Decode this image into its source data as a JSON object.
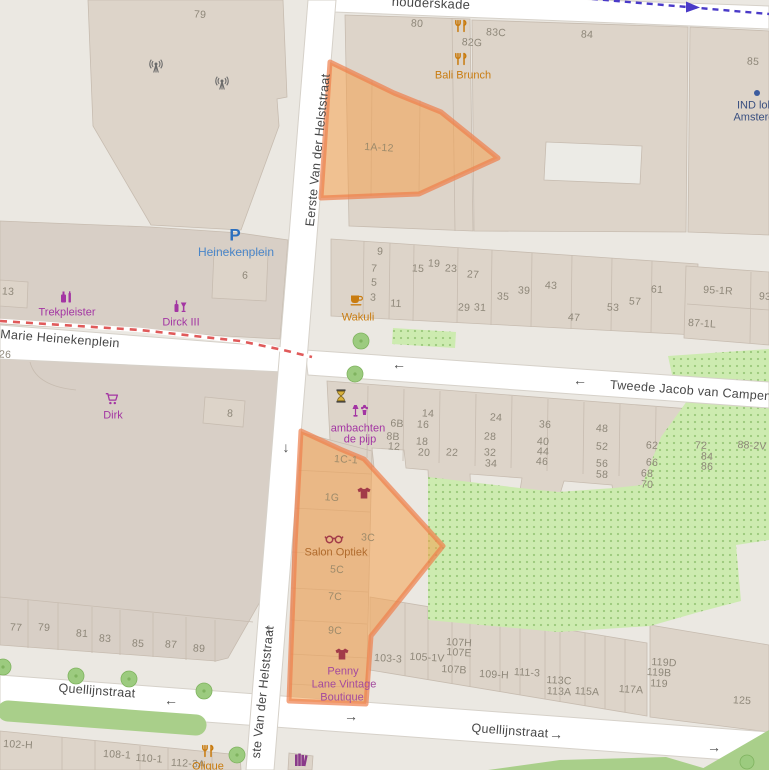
{
  "map": {
    "description_note": "OpenStreetMap-style map extract with two orange highlighted plots"
  },
  "colors": {
    "background": "#ebe8e2",
    "road": "#ffffff",
    "road_casing": "#d6d1c9",
    "building": "#ddd4c9",
    "building_dark": "#d8cfc6",
    "building_stroke": "#c7bcb0",
    "green_area": "#cdebb0",
    "green_dots": "#9cc97c",
    "grass": "#a9cf8a",
    "tree": "#9ccb7f",
    "tree_stroke": "#7fb35f",
    "selection_fill": "#f4a14f",
    "selection_stroke": "#ee7f4b",
    "route_blue": "#4a3ac8",
    "tram_dash_red": "#e05a5a",
    "house_number": "#8e8779",
    "selection_label": "#9c8a6a",
    "street_label": "#474747",
    "shop_purple": "#a335a3",
    "food_orange": "#c97c10",
    "clothes_maroon": "#a23b49",
    "parking_blue": "#2c6fbe",
    "label_blue": "#4a86c8",
    "ind_blue": "#3a5080"
  },
  "street_labels": [
    {
      "t": "houderskade",
      "x": 431,
      "y": 3,
      "r": 2.5,
      "s": 13
    },
    {
      "t": "Eerste Van der Helststraat",
      "x": 318,
      "y": 150,
      "r": -84,
      "s": 12.5
    },
    {
      "t": "ste Van der Helststraat",
      "x": 263,
      "y": 692,
      "r": -84,
      "s": 12.5
    },
    {
      "t": "Marie Heinekenplein",
      "x": 60,
      "y": 339,
      "r": 4.5,
      "s": 12.5
    },
    {
      "t": "Tweede Jacob van Campens",
      "x": 694,
      "y": 391,
      "r": 4.2,
      "s": 12.5
    },
    {
      "t": "Quellijnstraat",
      "x": 97,
      "y": 691,
      "r": 4.2,
      "s": 12.5
    },
    {
      "t": "Quellijnstraat",
      "x": 510,
      "y": 731,
      "r": 4.2,
      "s": 12.5
    }
  ],
  "house_numbers": [
    {
      "t": "79",
      "x": 200,
      "y": 15
    },
    {
      "t": "80",
      "x": 417,
      "y": 24
    },
    {
      "t": "82G",
      "x": 472,
      "y": 43
    },
    {
      "t": "83C",
      "x": 496,
      "y": 33
    },
    {
      "t": "84",
      "x": 587,
      "y": 35
    },
    {
      "t": "85",
      "x": 753,
      "y": 62
    },
    {
      "t": "13",
      "x": 8,
      "y": 292
    },
    {
      "t": "6",
      "x": 245,
      "y": 276
    },
    {
      "t": "26",
      "x": 5,
      "y": 355
    },
    {
      "t": "9",
      "x": 380,
      "y": 252
    },
    {
      "t": "7",
      "x": 374,
      "y": 269
    },
    {
      "t": "5",
      "x": 374,
      "y": 283
    },
    {
      "t": "3",
      "x": 373,
      "y": 298
    },
    {
      "t": "11",
      "x": 396,
      "y": 304
    },
    {
      "t": "15",
      "x": 418,
      "y": 269
    },
    {
      "t": "19",
      "x": 434,
      "y": 264
    },
    {
      "t": "23",
      "x": 451,
      "y": 269
    },
    {
      "t": "27",
      "x": 473,
      "y": 275
    },
    {
      "t": "29",
      "x": 464,
      "y": 308
    },
    {
      "t": "31",
      "x": 480,
      "y": 308
    },
    {
      "t": "35",
      "x": 503,
      "y": 297
    },
    {
      "t": "39",
      "x": 524,
      "y": 291
    },
    {
      "t": "43",
      "x": 551,
      "y": 286
    },
    {
      "t": "47",
      "x": 574,
      "y": 318
    },
    {
      "t": "53",
      "x": 613,
      "y": 308
    },
    {
      "t": "57",
      "x": 635,
      "y": 302
    },
    {
      "t": "61",
      "x": 657,
      "y": 290
    },
    {
      "t": "95-1R",
      "x": 718,
      "y": 291
    },
    {
      "t": "87-1L",
      "x": 702,
      "y": 324
    },
    {
      "t": "93",
      "x": 765,
      "y": 297
    },
    {
      "t": "8",
      "x": 230,
      "y": 414
    },
    {
      "t": "6B",
      "x": 397,
      "y": 424
    },
    {
      "t": "8B",
      "x": 393,
      "y": 437
    },
    {
      "t": "12",
      "x": 394,
      "y": 447
    },
    {
      "t": "14",
      "x": 428,
      "y": 414
    },
    {
      "t": "16",
      "x": 423,
      "y": 425
    },
    {
      "t": "18",
      "x": 422,
      "y": 442
    },
    {
      "t": "20",
      "x": 424,
      "y": 453
    },
    {
      "t": "22",
      "x": 452,
      "y": 453
    },
    {
      "t": "24",
      "x": 496,
      "y": 418
    },
    {
      "t": "28",
      "x": 490,
      "y": 437
    },
    {
      "t": "32",
      "x": 490,
      "y": 453
    },
    {
      "t": "34",
      "x": 491,
      "y": 464
    },
    {
      "t": "36",
      "x": 545,
      "y": 425
    },
    {
      "t": "40",
      "x": 543,
      "y": 442
    },
    {
      "t": "44",
      "x": 543,
      "y": 452
    },
    {
      "t": "46",
      "x": 542,
      "y": 462
    },
    {
      "t": "48",
      "x": 602,
      "y": 429
    },
    {
      "t": "52",
      "x": 602,
      "y": 447
    },
    {
      "t": "56",
      "x": 602,
      "y": 464
    },
    {
      "t": "58",
      "x": 602,
      "y": 475
    },
    {
      "t": "62",
      "x": 652,
      "y": 446
    },
    {
      "t": "66",
      "x": 652,
      "y": 463
    },
    {
      "t": "68",
      "x": 647,
      "y": 474
    },
    {
      "t": "70",
      "x": 647,
      "y": 485
    },
    {
      "t": "72",
      "x": 701,
      "y": 446
    },
    {
      "t": "84",
      "x": 707,
      "y": 457
    },
    {
      "t": "86",
      "x": 707,
      "y": 467
    },
    {
      "t": "88-2V",
      "x": 752,
      "y": 446
    },
    {
      "t": "77",
      "x": 16,
      "y": 628
    },
    {
      "t": "79",
      "x": 44,
      "y": 628
    },
    {
      "t": "81",
      "x": 82,
      "y": 634
    },
    {
      "t": "83",
      "x": 105,
      "y": 639
    },
    {
      "t": "85",
      "x": 138,
      "y": 644
    },
    {
      "t": "87",
      "x": 171,
      "y": 645
    },
    {
      "t": "89",
      "x": 199,
      "y": 649
    },
    {
      "t": "103-3",
      "x": 388,
      "y": 659
    },
    {
      "t": "105-1V",
      "x": 427,
      "y": 658
    },
    {
      "t": "107H",
      "x": 459,
      "y": 643
    },
    {
      "t": "107E",
      "x": 459,
      "y": 653
    },
    {
      "t": "107B",
      "x": 454,
      "y": 670
    },
    {
      "t": "109-H",
      "x": 494,
      "y": 675
    },
    {
      "t": "111-3",
      "x": 527,
      "y": 673
    },
    {
      "t": "113C",
      "x": 559,
      "y": 681
    },
    {
      "t": "113A",
      "x": 559,
      "y": 692
    },
    {
      "t": "115A",
      "x": 587,
      "y": 692
    },
    {
      "t": "117A",
      "x": 631,
      "y": 690
    },
    {
      "t": "119D",
      "x": 664,
      "y": 663
    },
    {
      "t": "119B",
      "x": 659,
      "y": 673
    },
    {
      "t": "119",
      "x": 659,
      "y": 684
    },
    {
      "t": "125",
      "x": 742,
      "y": 701
    },
    {
      "t": "102-H",
      "x": 18,
      "y": 745
    },
    {
      "t": "108-1",
      "x": 117,
      "y": 755
    },
    {
      "t": "110-1",
      "x": 149,
      "y": 759
    },
    {
      "t": "112-3A",
      "x": 188,
      "y": 764
    }
  ],
  "selection_labels": [
    {
      "t": "1A-12",
      "x": 379,
      "y": 148
    },
    {
      "t": "1C-1",
      "x": 346,
      "y": 460
    },
    {
      "t": "1G",
      "x": 332,
      "y": 498
    },
    {
      "t": "3C",
      "x": 368,
      "y": 538
    },
    {
      "t": "5C",
      "x": 337,
      "y": 570
    },
    {
      "t": "7C",
      "x": 335,
      "y": 597
    },
    {
      "t": "9C",
      "x": 335,
      "y": 631
    }
  ],
  "arrows": [
    {
      "glyph": "↓",
      "x": 286,
      "y": 447
    },
    {
      "glyph": "↓",
      "x": 269,
      "y": 628
    },
    {
      "glyph": "←",
      "x": 399,
      "y": 364
    },
    {
      "glyph": "←",
      "x": 580,
      "y": 380
    },
    {
      "glyph": "←",
      "x": 171,
      "y": 700
    },
    {
      "glyph": "→",
      "x": 351,
      "y": 716
    },
    {
      "glyph": "→",
      "x": 556,
      "y": 734
    },
    {
      "glyph": "→",
      "x": 714,
      "y": 747
    }
  ],
  "pois": [
    {
      "name": "restaurant-82g",
      "icon": "restaurant-icon",
      "icon_color": "#c97c10",
      "ix": 461,
      "iy": 26
    },
    {
      "name": "bali-brunch",
      "icon": "restaurant-icon",
      "icon_color": "#c97c10",
      "ix": 461,
      "iy": 59,
      "label": "Bali Brunch",
      "lx": 463,
      "ly": 76,
      "color": "#c97c10"
    },
    {
      "name": "ind-loket",
      "icon": "dot-icon",
      "icon_color": "#3b5b9e",
      "ix": 757,
      "iy": 93,
      "lines": [
        {
          "t": "IND lok",
          "x": 755,
          "y": 106
        },
        {
          "t": "Amsterda",
          "x": 757,
          "y": 118
        }
      ],
      "color": "#3a5080"
    },
    {
      "name": "parking-heinekenplein",
      "icon": "parking-icon",
      "icon_color": "#2c6fbe",
      "ix": 235,
      "iy": 235,
      "label": "Heinekenplein",
      "lx": 236,
      "ly": 252,
      "color": "#4a86c8",
      "ls": 12
    },
    {
      "name": "trekpleister",
      "icon": "chemist-icon",
      "icon_color": "#a335a3",
      "ix": 66,
      "iy": 297,
      "label": "Trekpleister",
      "lx": 67,
      "ly": 313,
      "color": "#a335a3"
    },
    {
      "name": "dirck-iii",
      "icon": "alcohol-icon",
      "icon_color": "#a335a3",
      "ix": 180,
      "iy": 306,
      "label": "Dirck III",
      "lx": 181,
      "ly": 323,
      "color": "#a335a3"
    },
    {
      "name": "dirk-supermarket",
      "icon": "cart-icon",
      "icon_color": "#a335a3",
      "ix": 112,
      "iy": 399,
      "label": "Dirk",
      "lx": 113,
      "ly": 416,
      "color": "#a335a3"
    },
    {
      "name": "wakuli",
      "icon": "cafe-icon",
      "icon_color": "#c97c10",
      "ix": 357,
      "iy": 300,
      "label": "Wakuli",
      "lx": 358,
      "ly": 318,
      "color": "#c97c10"
    },
    {
      "name": "ambachten-de-pijp",
      "icon": "crafts-icon",
      "icon_color": "#a335a3",
      "ix": 360,
      "iy": 411,
      "lines": [
        {
          "t": "ambachten",
          "x": 358,
          "y": 429
        },
        {
          "t": "de pijp",
          "x": 360,
          "y": 440
        }
      ],
      "color": "#a335a3"
    },
    {
      "name": "hourglass",
      "icon": "hourglass-icon",
      "icon_color": "#d8b13c",
      "ix": 341,
      "iy": 396
    },
    {
      "name": "clothes-shop",
      "icon": "tshirt-icon",
      "icon_color": "#a23b49",
      "ix": 364,
      "iy": 493
    },
    {
      "name": "salon-optiek",
      "icon": "glasses-icon",
      "icon_color": "#a23b49",
      "ix": 334,
      "iy": 539,
      "label": "Salon Optiek",
      "lx": 336,
      "ly": 553,
      "color": "#b06a2c"
    },
    {
      "name": "penny-lane-vintage",
      "icon": "tshirt-icon",
      "icon_color": "#a23b49",
      "ix": 342,
      "iy": 654,
      "lines": [
        {
          "t": "Penny",
          "x": 343,
          "y": 672
        },
        {
          "t": "Lane Vintage",
          "x": 344,
          "y": 685
        },
        {
          "t": "Boutique",
          "x": 342,
          "y": 698
        }
      ],
      "color": "#a44a9e"
    },
    {
      "name": "olique",
      "icon": "restaurant-icon",
      "icon_color": "#c97c10",
      "ix": 208,
      "iy": 751,
      "label": "Olique",
      "lx": 208,
      "ly": 767,
      "color": "#c97c10"
    },
    {
      "name": "bookshop",
      "icon": "books-icon",
      "icon_color": "#8a3a8a",
      "ix": 301,
      "iy": 760
    },
    {
      "name": "antenna-1",
      "icon": "antenna-icon",
      "icon_color": "#6b6b6b",
      "ix": 156,
      "iy": 67
    },
    {
      "name": "antenna-2",
      "icon": "antenna-icon",
      "icon_color": "#6b6b6b",
      "ix": 222,
      "iy": 84
    }
  ]
}
